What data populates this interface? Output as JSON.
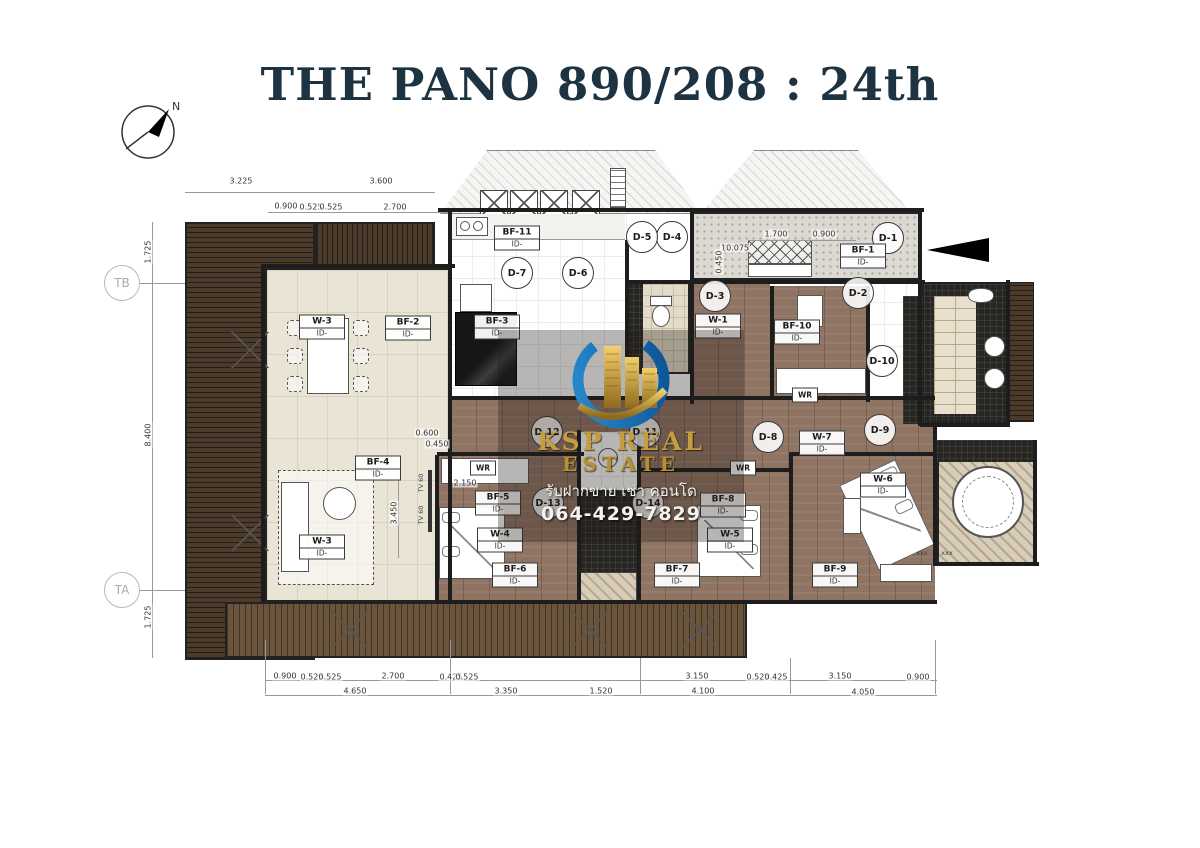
{
  "title": "THE PANO 890/208 : 24th",
  "compass": {
    "north_label": "N"
  },
  "watermark": {
    "brand_line1": "KSP REAL",
    "brand_line2": "ESTATE",
    "tagline_thai": "รับฝากขาย เช่า คอนโด",
    "phone": "064-429-7829"
  },
  "colors": {
    "title_navy": "#1d3341",
    "logo_blue": "#1474c4",
    "logo_gold": "#c59c3e"
  },
  "grid_bubbles": [
    {
      "text": "TB",
      "x": 122,
      "y": 283
    },
    {
      "text": "TA",
      "x": 122,
      "y": 590
    }
  ],
  "door_labels": [
    {
      "text": "D-1",
      "x": 888,
      "y": 238
    },
    {
      "text": "D-2",
      "x": 858,
      "y": 293
    },
    {
      "text": "D-3",
      "x": 715,
      "y": 296
    },
    {
      "text": "D-4",
      "x": 672,
      "y": 237
    },
    {
      "text": "D-5",
      "x": 642,
      "y": 237
    },
    {
      "text": "D-6",
      "x": 578,
      "y": 273
    },
    {
      "text": "D-7",
      "x": 517,
      "y": 273
    },
    {
      "text": "D-8",
      "x": 768,
      "y": 437
    },
    {
      "text": "D-9",
      "x": 880,
      "y": 430
    },
    {
      "text": "D-10",
      "x": 882,
      "y": 361
    },
    {
      "text": "D-11",
      "x": 645,
      "y": 432
    },
    {
      "text": "D-12",
      "x": 547,
      "y": 432
    },
    {
      "text": "D-13",
      "x": 548,
      "y": 503
    },
    {
      "text": "D-14",
      "x": 648,
      "y": 503
    }
  ],
  "fixture_labels": [
    {
      "text": "BF-1",
      "sub": "ID-",
      "x": 863,
      "y": 256
    },
    {
      "text": "BF-2",
      "sub": "ID-",
      "x": 408,
      "y": 328
    },
    {
      "text": "BF-3",
      "sub": "ID-",
      "x": 497,
      "y": 327
    },
    {
      "text": "BF-4",
      "sub": "ID-",
      "x": 378,
      "y": 468
    },
    {
      "text": "BF-5",
      "sub": "ID-",
      "x": 498,
      "y": 503
    },
    {
      "text": "BF-6",
      "sub": "ID-",
      "x": 515,
      "y": 575
    },
    {
      "text": "BF-7",
      "sub": "ID-",
      "x": 677,
      "y": 575
    },
    {
      "text": "BF-8",
      "sub": "ID-",
      "x": 723,
      "y": 505
    },
    {
      "text": "BF-9",
      "sub": "ID-",
      "x": 835,
      "y": 575
    },
    {
      "text": "BF-10",
      "sub": "ID-",
      "x": 797,
      "y": 332
    },
    {
      "text": "BF-11",
      "sub": "ID-",
      "x": 517,
      "y": 238
    }
  ],
  "window_labels": [
    {
      "text": "W-1",
      "sub": "ID-",
      "x": 718,
      "y": 326
    },
    {
      "text": "W-3",
      "sub": "ID-",
      "x": 322,
      "y": 327
    },
    {
      "text": "W-3",
      "sub": "ID-",
      "x": 322,
      "y": 547
    },
    {
      "text": "W-4",
      "sub": "ID-",
      "x": 500,
      "y": 540
    },
    {
      "text": "W-5",
      "sub": "ID-",
      "x": 730,
      "y": 540
    },
    {
      "text": "W-6",
      "sub": "ID-",
      "x": 883,
      "y": 485
    },
    {
      "text": "W-7",
      "sub": "ID-",
      "x": 822,
      "y": 443
    }
  ],
  "wardrobe_labels": [
    {
      "text": "WR",
      "x": 483,
      "y": 468
    },
    {
      "text": "WR",
      "x": 743,
      "y": 468
    },
    {
      "text": "WR",
      "x": 805,
      "y": 395
    }
  ],
  "dimension_labels": [
    {
      "text": "3.225",
      "x": 241,
      "y": 181
    },
    {
      "text": "3.600",
      "x": 381,
      "y": 181
    },
    {
      "text": "0.900",
      "x": 286,
      "y": 206
    },
    {
      "text": "0.525",
      "x": 311,
      "y": 207
    },
    {
      "text": "0.525",
      "x": 331,
      "y": 207
    },
    {
      "text": "2.700",
      "x": 395,
      "y": 207
    },
    {
      "text": "1.700",
      "x": 776,
      "y": 234
    },
    {
      "text": "0.900",
      "x": 824,
      "y": 234
    },
    {
      "text": "10.075",
      "x": 735,
      "y": 248
    },
    {
      "text": "0.450",
      "x": 719,
      "y": 262,
      "v": true
    },
    {
      "text": "1.725",
      "x": 148,
      "y": 252,
      "v": true
    },
    {
      "text": "8.400",
      "x": 148,
      "y": 435,
      "v": true
    },
    {
      "text": "1.725",
      "x": 148,
      "y": 617,
      "v": true
    },
    {
      "text": "0.600",
      "x": 427,
      "y": 433
    },
    {
      "text": "0.450",
      "x": 437,
      "y": 444
    },
    {
      "text": "3.450",
      "x": 394,
      "y": 513,
      "v": true
    },
    {
      "text": "2.150",
      "x": 465,
      "y": 483
    },
    {
      "text": "0.900",
      "x": 285,
      "y": 676
    },
    {
      "text": "0.525",
      "x": 312,
      "y": 677
    },
    {
      "text": "0.525",
      "x": 330,
      "y": 677
    },
    {
      "text": "2.700",
      "x": 393,
      "y": 676
    },
    {
      "text": "0.425",
      "x": 451,
      "y": 677
    },
    {
      "text": "0.525",
      "x": 467,
      "y": 677
    },
    {
      "text": "3.150",
      "x": 697,
      "y": 676
    },
    {
      "text": "0.525",
      "x": 758,
      "y": 677
    },
    {
      "text": "0.425",
      "x": 776,
      "y": 677
    },
    {
      "text": "3.150",
      "x": 840,
      "y": 676
    },
    {
      "text": "0.900",
      "x": 918,
      "y": 677
    },
    {
      "text": "4.650",
      "x": 355,
      "y": 691
    },
    {
      "text": "3.350",
      "x": 506,
      "y": 691
    },
    {
      "text": "1.520",
      "x": 601,
      "y": 691
    },
    {
      "text": "4.100",
      "x": 703,
      "y": 691
    },
    {
      "text": "4.050",
      "x": 863,
      "y": 692
    }
  ],
  "misc_labels": [
    {
      "text": "xxx",
      "x": 922,
      "y": 553
    },
    {
      "text": "xxx",
      "x": 947,
      "y": 553
    },
    {
      "text": "TV 60",
      "x": 421,
      "y": 483,
      "v": true
    },
    {
      "text": "TV 60",
      "x": 421,
      "y": 515,
      "v": true
    }
  ]
}
